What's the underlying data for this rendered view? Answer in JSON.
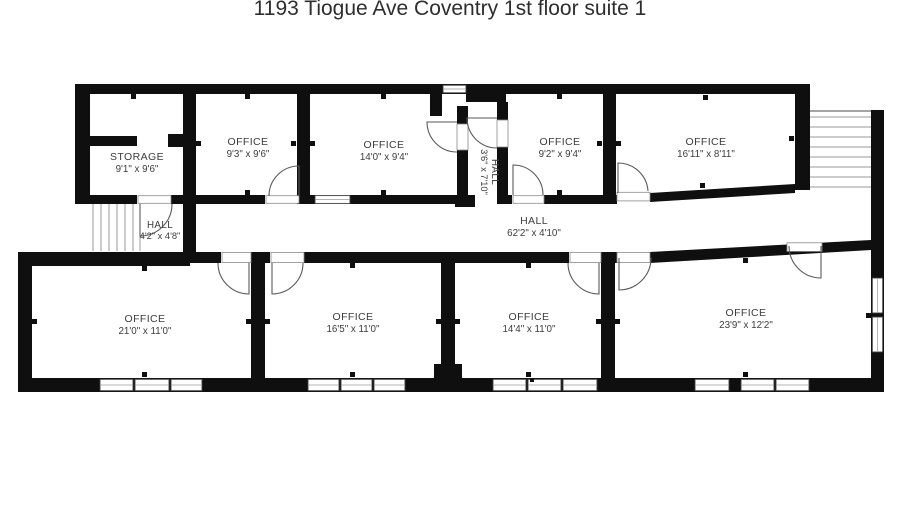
{
  "title": "1193 Tiogue Ave Coventry 1st floor suite 1",
  "rooms": [
    {
      "id": "storage",
      "name": "STORAGE",
      "dims": "9'1\" x 9'6\""
    },
    {
      "id": "office-93",
      "name": "OFFICE",
      "dims": "9'3\" x 9'6\""
    },
    {
      "id": "office-140",
      "name": "OFFICE",
      "dims": "14'0\" x 9'4\""
    },
    {
      "id": "hall-36",
      "name": "HALL",
      "dims": "3'6\" x 7'10\""
    },
    {
      "id": "office-92",
      "name": "OFFICE",
      "dims": "9'2\" x 9'4\""
    },
    {
      "id": "office-1611",
      "name": "OFFICE",
      "dims": "16'11\" x 8'11\""
    },
    {
      "id": "hall-42",
      "name": "HALL",
      "dims": "4'2\" x 4'8\""
    },
    {
      "id": "hall-622",
      "name": "HALL",
      "dims": "62'2\" x 4'10\""
    },
    {
      "id": "office-210",
      "name": "OFFICE",
      "dims": "21'0\" x 11'0\""
    },
    {
      "id": "office-165",
      "name": "OFFICE",
      "dims": "16'5\" x 11'0\""
    },
    {
      "id": "office-144",
      "name": "OFFICE",
      "dims": "14'4\" x 11'0\""
    },
    {
      "id": "office-239",
      "name": "OFFICE",
      "dims": "23'9\" x 12'2\""
    }
  ],
  "colors": {
    "wall": "#0f0f0f",
    "line": "#9a9a9a",
    "text": "#3c3c3c",
    "background": "#ffffff"
  }
}
